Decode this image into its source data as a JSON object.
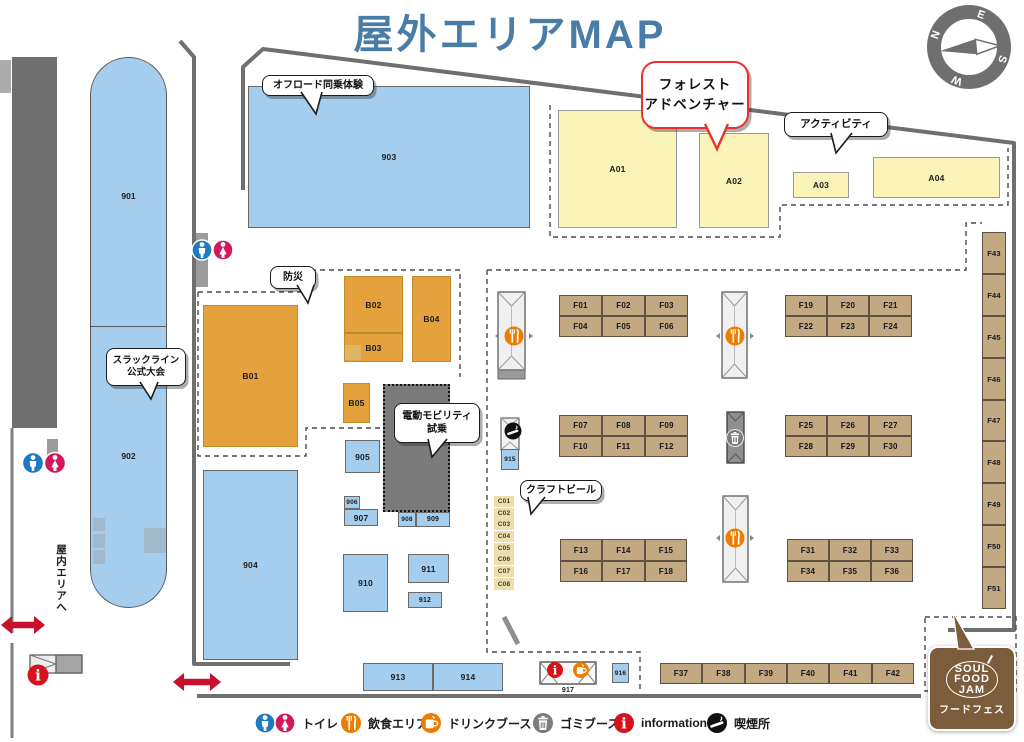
{
  "header": {
    "title": "屋外エリアMAP"
  },
  "compass": {
    "n": "N",
    "e": "E",
    "s": "S",
    "w": "W"
  },
  "labels": {
    "indoor_exit": "屋内エリアへ"
  },
  "bubbles": {
    "offroad": "オフロード同乗体験",
    "forest_line1": "フォレスト",
    "forest_line2": "アドベンチャー",
    "activity": "アクティビティ",
    "disaster": "防災",
    "slackline_line1": "スラックライン",
    "slackline_line2": "公式大会",
    "mobility_line1": "電動モビリティ",
    "mobility_line2": "試乗",
    "craft_beer": "クラフトビール"
  },
  "logo": {
    "l1": "SOUL",
    "l2": "FOOD",
    "l3": "JAM",
    "caption": "フードフェス"
  },
  "legend": [
    {
      "icon": "toilet-icon",
      "label": "トイレ"
    },
    {
      "icon": "food-icon",
      "label": "飲食エリア"
    },
    {
      "icon": "drink-icon",
      "label": "ドリンクブース"
    },
    {
      "icon": "trash-icon",
      "label": "ゴミブース"
    },
    {
      "icon": "info-icon",
      "label": "information"
    },
    {
      "icon": "smoking-icon",
      "label": "喫煙所"
    }
  ],
  "capsule": {
    "top_label": "901",
    "bottom_label": "902"
  },
  "colors": {
    "title_blue": "#4A7CA8",
    "booth_blue": "#A5CEEE",
    "booth_orange": "#E5A23C",
    "booth_yellow": "#FAF4B8",
    "booth_tan": "#C2A982",
    "booth_khaki": "#EDDFAD",
    "accent_red": "#C8102E",
    "toilet_blue": "#1E79C0",
    "toilet_pink": "#D3175C",
    "food_orange": "#ED7D00",
    "trash_gray": "#7C7C7C",
    "info_red": "#D6121C",
    "smoke_black": "#101010",
    "logo_brown": "#7B5C3B"
  },
  "booths": [
    {
      "label": "903",
      "x": 248,
      "y": 86,
      "w": 282,
      "h": 142,
      "t": "blue"
    },
    {
      "label": "904",
      "x": 203,
      "y": 470,
      "w": 95,
      "h": 190,
      "t": "blue"
    },
    {
      "label": "905",
      "x": 345,
      "y": 440,
      "w": 35,
      "h": 33,
      "t": "blue"
    },
    {
      "label": "906",
      "x": 344,
      "y": 496,
      "w": 16,
      "h": 13,
      "t": "blue",
      "fs": 6.5
    },
    {
      "label": "907",
      "x": 344,
      "y": 509,
      "w": 34,
      "h": 17,
      "t": "blue"
    },
    {
      "label": "908",
      "x": 398,
      "y": 512,
      "w": 18,
      "h": 15,
      "t": "blue",
      "fs": 6.5
    },
    {
      "label": "909",
      "x": 416,
      "y": 512,
      "w": 34,
      "h": 15,
      "t": "blue",
      "fs": 7
    },
    {
      "label": "910",
      "x": 343,
      "y": 554,
      "w": 45,
      "h": 58,
      "t": "blue"
    },
    {
      "label": "911",
      "x": 408,
      "y": 554,
      "w": 41,
      "h": 29,
      "t": "blue"
    },
    {
      "label": "912",
      "x": 408,
      "y": 592,
      "w": 34,
      "h": 16,
      "t": "blue",
      "fs": 7
    },
    {
      "label": "913",
      "x": 363,
      "y": 663,
      "w": 70,
      "h": 28,
      "t": "blue"
    },
    {
      "label": "914",
      "x": 433,
      "y": 663,
      "w": 70,
      "h": 28,
      "t": "blue"
    },
    {
      "label": "915",
      "x": 501,
      "y": 449,
      "w": 18,
      "h": 21,
      "t": "blue",
      "fs": 6.5
    },
    {
      "label": "916",
      "x": 612,
      "y": 663,
      "w": 17,
      "h": 20,
      "t": "blue",
      "fs": 6.5
    },
    {
      "label": "917",
      "x": 556,
      "y": 685,
      "w": 24,
      "h": 10,
      "t": "plain"
    },
    {
      "label": "B01",
      "x": 203,
      "y": 305,
      "w": 95,
      "h": 142,
      "t": "orange"
    },
    {
      "label": "B02",
      "x": 344,
      "y": 276,
      "w": 59,
      "h": 57,
      "t": "orange"
    },
    {
      "label": "B03",
      "x": 344,
      "y": 333,
      "w": 59,
      "h": 29,
      "t": "orange"
    },
    {
      "label": "",
      "x": 345,
      "y": 345,
      "w": 16,
      "h": 15,
      "t": "patch"
    },
    {
      "label": "B04",
      "x": 412,
      "y": 276,
      "w": 39,
      "h": 86,
      "t": "orange"
    },
    {
      "label": "B05",
      "x": 343,
      "y": 383,
      "w": 27,
      "h": 40,
      "t": "orange"
    },
    {
      "label": "A01",
      "x": 558,
      "y": 110,
      "w": 119,
      "h": 118,
      "t": "yellow"
    },
    {
      "label": "A02",
      "x": 699,
      "y": 133,
      "w": 70,
      "h": 95,
      "t": "yellow"
    },
    {
      "label": "A03",
      "x": 793,
      "y": 172,
      "w": 56,
      "h": 26,
      "t": "yellow"
    },
    {
      "label": "A04",
      "x": 873,
      "y": 157,
      "w": 127,
      "h": 41,
      "t": "yellow"
    },
    {
      "label": "",
      "x": 383,
      "y": 384,
      "w": 67,
      "h": 128,
      "t": "mobility"
    },
    {
      "label": "F01",
      "x": 559,
      "y": 295,
      "w": 43,
      "h": 21,
      "t": "tan"
    },
    {
      "label": "F02",
      "x": 602,
      "y": 295,
      "w": 43,
      "h": 21,
      "t": "tan"
    },
    {
      "label": "F03",
      "x": 645,
      "y": 295,
      "w": 43,
      "h": 21,
      "t": "tan"
    },
    {
      "label": "F04",
      "x": 559,
      "y": 316,
      "w": 43,
      "h": 21,
      "t": "tan"
    },
    {
      "label": "F05",
      "x": 602,
      "y": 316,
      "w": 43,
      "h": 21,
      "t": "tan"
    },
    {
      "label": "F06",
      "x": 645,
      "y": 316,
      "w": 43,
      "h": 21,
      "t": "tan"
    },
    {
      "label": "F19",
      "x": 785,
      "y": 295,
      "w": 42,
      "h": 21,
      "t": "tan"
    },
    {
      "label": "F20",
      "x": 827,
      "y": 295,
      "w": 42,
      "h": 21,
      "t": "tan"
    },
    {
      "label": "F21",
      "x": 869,
      "y": 295,
      "w": 43,
      "h": 21,
      "t": "tan"
    },
    {
      "label": "F22",
      "x": 785,
      "y": 316,
      "w": 42,
      "h": 21,
      "t": "tan"
    },
    {
      "label": "F23",
      "x": 827,
      "y": 316,
      "w": 42,
      "h": 21,
      "t": "tan"
    },
    {
      "label": "F24",
      "x": 869,
      "y": 316,
      "w": 43,
      "h": 21,
      "t": "tan"
    },
    {
      "label": "F07",
      "x": 559,
      "y": 415,
      "w": 43,
      "h": 21,
      "t": "tan"
    },
    {
      "label": "F08",
      "x": 602,
      "y": 415,
      "w": 43,
      "h": 21,
      "t": "tan"
    },
    {
      "label": "F09",
      "x": 645,
      "y": 415,
      "w": 43,
      "h": 21,
      "t": "tan"
    },
    {
      "label": "F10",
      "x": 559,
      "y": 436,
      "w": 43,
      "h": 21,
      "t": "tan"
    },
    {
      "label": "F11",
      "x": 602,
      "y": 436,
      "w": 43,
      "h": 21,
      "t": "tan"
    },
    {
      "label": "F12",
      "x": 645,
      "y": 436,
      "w": 43,
      "h": 21,
      "t": "tan"
    },
    {
      "label": "F25",
      "x": 785,
      "y": 415,
      "w": 42,
      "h": 21,
      "t": "tan"
    },
    {
      "label": "F26",
      "x": 827,
      "y": 415,
      "w": 42,
      "h": 21,
      "t": "tan"
    },
    {
      "label": "F27",
      "x": 869,
      "y": 415,
      "w": 43,
      "h": 21,
      "t": "tan"
    },
    {
      "label": "F28",
      "x": 785,
      "y": 436,
      "w": 42,
      "h": 21,
      "t": "tan"
    },
    {
      "label": "F29",
      "x": 827,
      "y": 436,
      "w": 42,
      "h": 21,
      "t": "tan"
    },
    {
      "label": "F30",
      "x": 869,
      "y": 436,
      "w": 43,
      "h": 21,
      "t": "tan"
    },
    {
      "label": "F13",
      "x": 560,
      "y": 539,
      "w": 42,
      "h": 22,
      "t": "tan"
    },
    {
      "label": "F14",
      "x": 602,
      "y": 539,
      "w": 43,
      "h": 22,
      "t": "tan"
    },
    {
      "label": "F15",
      "x": 645,
      "y": 539,
      "w": 42,
      "h": 22,
      "t": "tan"
    },
    {
      "label": "F16",
      "x": 560,
      "y": 561,
      "w": 42,
      "h": 21,
      "t": "tan"
    },
    {
      "label": "F17",
      "x": 602,
      "y": 561,
      "w": 43,
      "h": 21,
      "t": "tan"
    },
    {
      "label": "F18",
      "x": 645,
      "y": 561,
      "w": 42,
      "h": 21,
      "t": "tan"
    },
    {
      "label": "F31",
      "x": 787,
      "y": 539,
      "w": 42,
      "h": 22,
      "t": "tan"
    },
    {
      "label": "F32",
      "x": 829,
      "y": 539,
      "w": 42,
      "h": 22,
      "t": "tan"
    },
    {
      "label": "F33",
      "x": 871,
      "y": 539,
      "w": 42,
      "h": 22,
      "t": "tan"
    },
    {
      "label": "F34",
      "x": 787,
      "y": 561,
      "w": 42,
      "h": 21,
      "t": "tan"
    },
    {
      "label": "F35",
      "x": 829,
      "y": 561,
      "w": 42,
      "h": 21,
      "t": "tan"
    },
    {
      "label": "F36",
      "x": 871,
      "y": 561,
      "w": 42,
      "h": 21,
      "t": "tan"
    },
    {
      "label": "F37",
      "x": 660,
      "y": 663,
      "w": 42,
      "h": 21,
      "t": "tan"
    },
    {
      "label": "F38",
      "x": 702,
      "y": 663,
      "w": 43,
      "h": 21,
      "t": "tan"
    },
    {
      "label": "F39",
      "x": 745,
      "y": 663,
      "w": 42,
      "h": 21,
      "t": "tan"
    },
    {
      "label": "F40",
      "x": 787,
      "y": 663,
      "w": 42,
      "h": 21,
      "t": "tan"
    },
    {
      "label": "F41",
      "x": 829,
      "y": 663,
      "w": 43,
      "h": 21,
      "t": "tan"
    },
    {
      "label": "F42",
      "x": 872,
      "y": 663,
      "w": 42,
      "h": 21,
      "t": "tan"
    },
    {
      "label": "F43",
      "x": 982,
      "y": 232,
      "w": 24,
      "h": 42,
      "t": "tan",
      "fs": 7.5
    },
    {
      "label": "F44",
      "x": 982,
      "y": 274,
      "w": 24,
      "h": 42,
      "t": "tan",
      "fs": 7.5
    },
    {
      "label": "F45",
      "x": 982,
      "y": 316,
      "w": 24,
      "h": 42,
      "t": "tan",
      "fs": 7.5
    },
    {
      "label": "F46",
      "x": 982,
      "y": 358,
      "w": 24,
      "h": 42,
      "t": "tan",
      "fs": 7.5
    },
    {
      "label": "F47",
      "x": 982,
      "y": 400,
      "w": 24,
      "h": 41,
      "t": "tan",
      "fs": 7.5
    },
    {
      "label": "F48",
      "x": 982,
      "y": 441,
      "w": 24,
      "h": 42,
      "t": "tan",
      "fs": 7.5
    },
    {
      "label": "F49",
      "x": 982,
      "y": 483,
      "w": 24,
      "h": 42,
      "t": "tan",
      "fs": 7.5
    },
    {
      "label": "F50",
      "x": 982,
      "y": 525,
      "w": 24,
      "h": 42,
      "t": "tan",
      "fs": 7.5
    },
    {
      "label": "F51",
      "x": 982,
      "y": 567,
      "w": 24,
      "h": 42,
      "t": "tan",
      "fs": 7.5
    },
    {
      "label": "C01",
      "x": 494,
      "y": 496,
      "w": 20,
      "h": 11,
      "t": "khaki"
    },
    {
      "label": "C02",
      "x": 494,
      "y": 508,
      "w": 20,
      "h": 11,
      "t": "khaki"
    },
    {
      "label": "C03",
      "x": 494,
      "y": 519,
      "w": 20,
      "h": 11,
      "t": "khaki"
    },
    {
      "label": "C04",
      "x": 494,
      "y": 531,
      "w": 20,
      "h": 11,
      "t": "khaki"
    },
    {
      "label": "C05",
      "x": 494,
      "y": 543,
      "w": 20,
      "h": 11,
      "t": "khaki"
    },
    {
      "label": "C06",
      "x": 494,
      "y": 554,
      "w": 20,
      "h": 11,
      "t": "khaki"
    },
    {
      "label": "C07",
      "x": 494,
      "y": 566,
      "w": 20,
      "h": 11,
      "t": "khaki"
    },
    {
      "label": "C08",
      "x": 494,
      "y": 578,
      "w": 20,
      "h": 12,
      "t": "khaki"
    }
  ]
}
